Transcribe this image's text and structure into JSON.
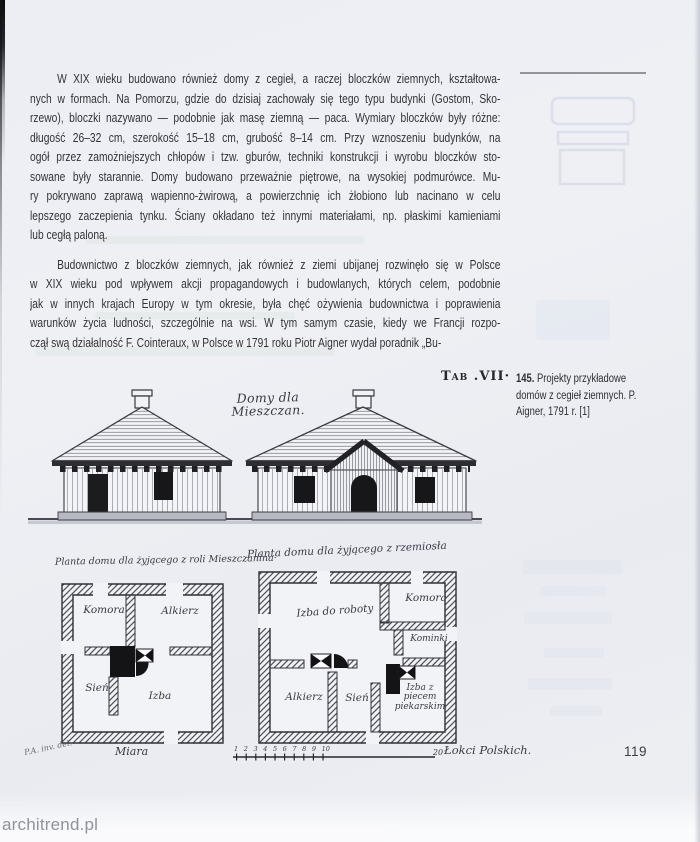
{
  "page": {
    "number": "119",
    "watermark": "architrend.pl"
  },
  "article": {
    "paragraph1_lines": [
      "W XIX wieku budowano również domy z cegieł, a raczej bloczków ziemnych, kształtowa-",
      "nych w formach. Na Pomorzu, gdzie do dzisiaj zachowały się tego typu budynki (Gostom, Sko-",
      "rzewo), bloczki nazywano — podobnie jak masę ziemną — paca. Wymiary bloczków były różne:",
      "długość 26–32 cm, szerokość 15–18 cm, grubość 8–14 cm. Przy wznoszeniu budynków, na",
      "ogół przez zamożniejszych chłopów i tzw. gburów, techniki konstrukcji i wyrobu bloczków sto-",
      "sowane były starannie. Domy budowano przeważnie piętrowe, na wysokiej podmurówce. Mu-",
      "ry pokrywano zaprawą wapienno-żwirową, a powierzchnię ich żłobiono lub nacinano w celu",
      "lepszego zaczepienia tynku. Ściany okładano też innymi materiałami, np. płaskimi kamieniami",
      "lub cegłą paloną."
    ],
    "paragraph2_lines": [
      "Budownictwo z bloczków ziemnych, jak również z ziemi ubijanej rozwinęło się w Polsce",
      "w XIX wieku pod wpływem akcji propagandowych i budowlanych, których celem, podobnie",
      "jak w innych krajach Europy w tym okresie, była chęć ożywienia budownictwa i poprawienia",
      "warunków życia ludności, szczególnie na wsi. W tym samym czasie, kiedy we Francji rozpo-",
      "czął swą działalność F. Cointeraux, w Polsce w 1791 roku Piotr Aigner wydał poradnik „Bu-"
    ]
  },
  "figure": {
    "tab_label": "Tab .VII·",
    "caption": {
      "number": "145.",
      "text": " Projekty przykładowe domów z cegieł ziemnych. P. Aigner, 1791 r. [1]"
    },
    "plate": {
      "title": "Domy dla Mieszczan.",
      "plan_left": {
        "title": "Planta domu dla żyjącego z roli Mieszczanina·",
        "rooms": {
          "top_left": "Komora",
          "top_right": "Alkierz",
          "bottom_left": "Sień",
          "bottom_right": "Izba"
        }
      },
      "plan_right": {
        "title": "Planta domu dla żyjącego z rzemiosła",
        "rooms": {
          "workroom": "Izba do roboty",
          "chamber": "Komora",
          "fireplaces": "Kominki",
          "alcove": "Alkierz",
          "hall": "Sień",
          "oven_room": "Izba z piecem piekarskim"
        }
      },
      "scale": {
        "label": "Miara",
        "ticks": [
          "1",
          "2",
          "3",
          "4",
          "5",
          "6",
          "7",
          "8",
          "9",
          "10"
        ],
        "end_value": "20",
        "end_label": "Łokci Polskich.",
        "signature": "P.A. inv. del."
      }
    }
  }
}
